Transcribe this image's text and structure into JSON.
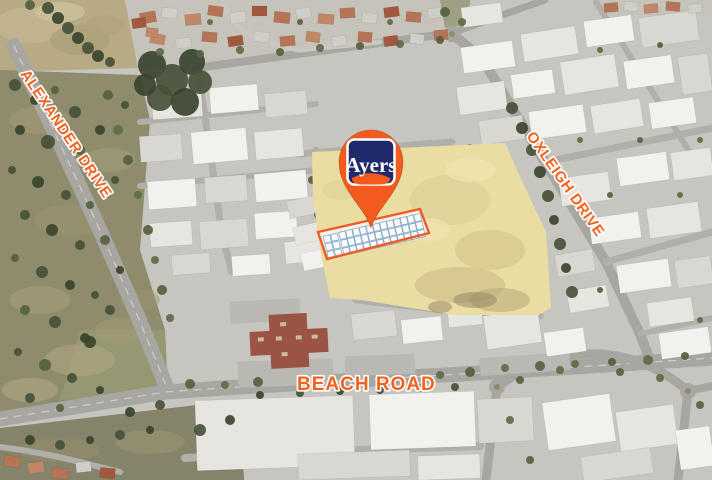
{
  "road_labels": {
    "alexander": "ALEXANDER DRIVE",
    "oxleigh": "OXLEIGH DRIVE",
    "beach": "BEACH ROAD"
  },
  "marker": {
    "brand": "Ayers"
  },
  "colors": {
    "road_label": "#F4621E",
    "road_label_outline": "#FFFFFF",
    "pin": "#F25A1E",
    "logo_background": "#20296B",
    "logo_text": "#FFFFFF",
    "logo_border": "#FFFFFF",
    "highlight_lot_border": "#F05A28",
    "highlight_vacant_land": "#E9DDA2",
    "plan_fill": "#F4F3EC",
    "plan_lot_outline": "#7FA6CC"
  }
}
